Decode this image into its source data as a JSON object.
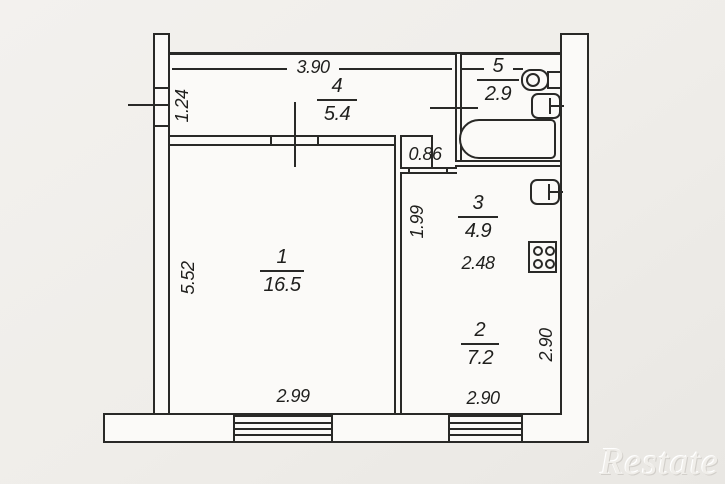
{
  "plan": {
    "watermark": "Restate",
    "rooms": [
      {
        "number": "1",
        "area": "16.5"
      },
      {
        "number": "2",
        "area": "7.2"
      },
      {
        "number": "3",
        "area": "4.9"
      },
      {
        "number": "4",
        "area": "5.4"
      },
      {
        "number": "5",
        "area": "2.9"
      }
    ],
    "dimensions": {
      "hall_width": "3.90",
      "left_wall_upper": "1.24",
      "room1_depth": "5.52",
      "room1_width": "2.99",
      "corridor_width": "0.86",
      "kitchen_wall": "1.99",
      "kitchen_width": "2.48",
      "room2_width": "2.90",
      "room2_depth": "2.90"
    },
    "icons": {
      "bath": "bathtub-icon",
      "toilet": "toilet-icon",
      "bath_sink": "sink-icon",
      "kitchen_sink": "sink-icon",
      "stove": "stove-icon",
      "windows": [
        "window-icon",
        "window-icon"
      ]
    },
    "colors": {
      "line": "#292927",
      "paper": "#fbfaf8",
      "background": "#efede9",
      "text": "#1f1f1d"
    }
  }
}
